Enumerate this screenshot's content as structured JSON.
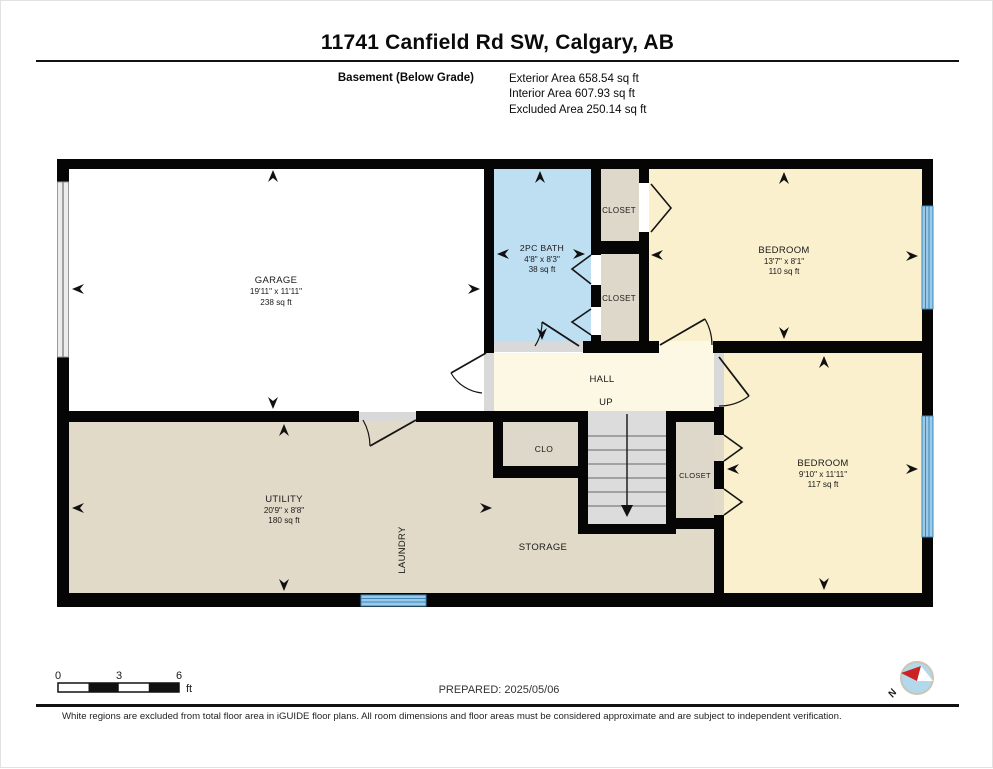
{
  "page": {
    "title": "11741 Canfield Rd SW, Calgary, AB",
    "floor_label": "Basement (Below Grade)",
    "exterior": "Exterior Area 658.54 sq ft",
    "interior": "Interior Area 607.93 sq ft",
    "excluded": "Excluded Area 250.14 sq ft"
  },
  "rooms": {
    "garage": {
      "name": "GARAGE",
      "dims": "19'11\" x 11'11\"",
      "area": "238 sq ft"
    },
    "bath": {
      "name": "2PC BATH",
      "dims": "4'8\" x 8'3\"",
      "area": "38 sq ft"
    },
    "closet_top": {
      "name": "CLOSET"
    },
    "closet_mid": {
      "name": "CLOSET"
    },
    "bedroom_upper": {
      "name": "BEDROOM",
      "dims": "13'7\" x 8'1\"",
      "area": "110 sq ft"
    },
    "hall": {
      "name": "HALL",
      "up": "UP"
    },
    "clo": {
      "name": "CLO"
    },
    "closet_lower": {
      "name": "CLOSET"
    },
    "bedroom_lower": {
      "name": "BEDROOM",
      "dims": "9'10\" x 11'11\"",
      "area": "117 sq ft"
    },
    "utility": {
      "name": "UTILITY",
      "dims": "20'9\" x 8'8\"",
      "area": "180 sq ft"
    },
    "laundry": {
      "name": "LAUNDRY"
    },
    "storage": {
      "name": "STORAGE"
    }
  },
  "scale": {
    "t0": "0",
    "t3": "3",
    "t6": "6",
    "unit": "ft"
  },
  "compass": {
    "north": "N"
  },
  "footer": {
    "prepared": "PREPARED: 2025/05/06",
    "disclaimer": "White regions are excluded from total floor area in iGUIDE floor plans. All room dimensions and floor areas must be considered approximate and are subject to independent verification."
  },
  "colors": {
    "wall": "#050505",
    "garage_floor": "#ffffff",
    "bath_floor": "#bedff2",
    "bedroom_floor": "#faf0cd",
    "hall_floor": "#fcf8e3",
    "utility_floor": "#e1dac8",
    "closet_floor": "#ded8ca",
    "stairs": "#dcdcdc",
    "threshold": "#d9d9d9",
    "window_blue": "#3a89bf",
    "window_fill": "#9cc9e6",
    "compass_red": "#cc2222",
    "compass_face": "#b4d8eb"
  }
}
